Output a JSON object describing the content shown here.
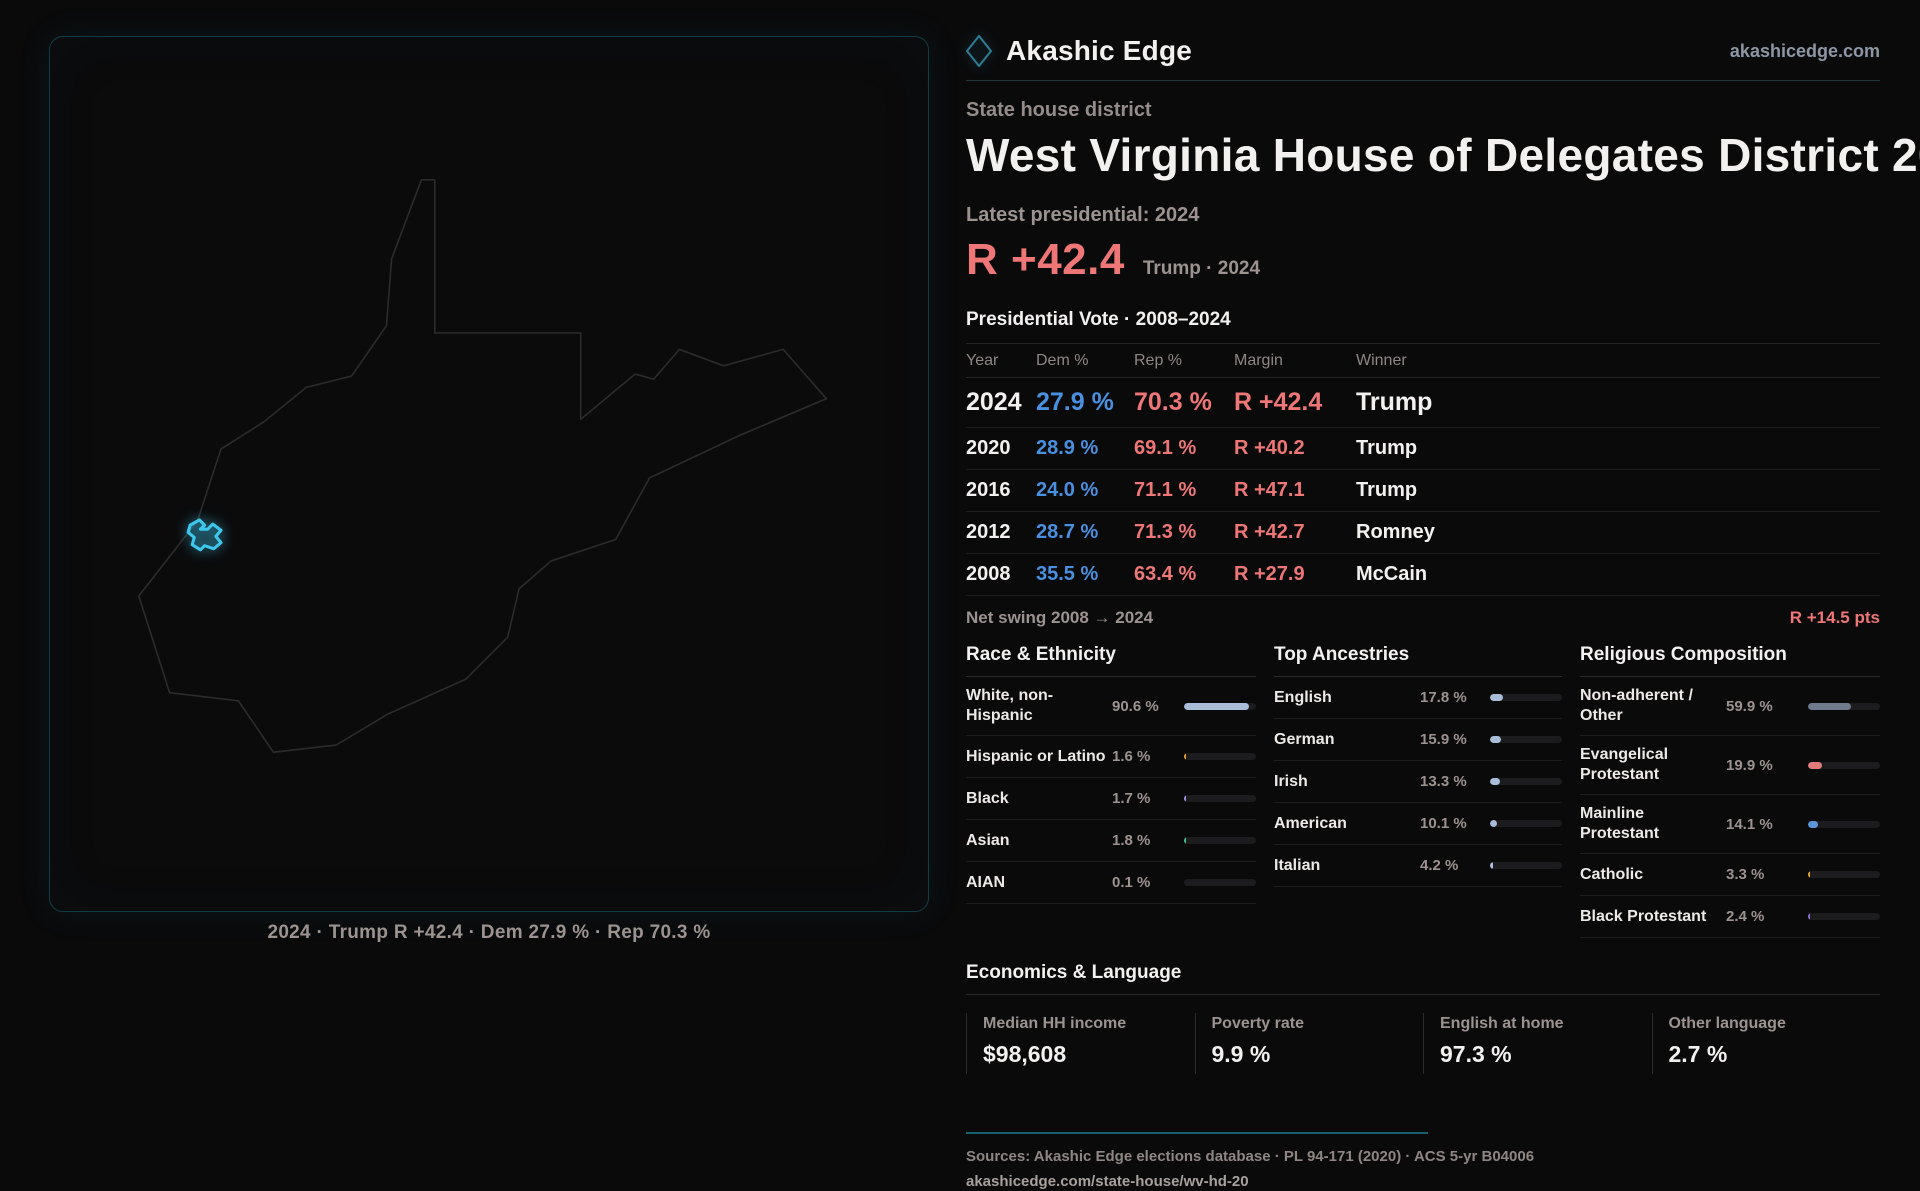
{
  "brand": {
    "name": "Akashic Edge",
    "domain": "akashicedge.com"
  },
  "page": {
    "kicker": "State house district",
    "title": "West Virginia House of Delegates District 20",
    "latest_label": "Latest presidential: 2024",
    "headline_margin": "R +42.4",
    "headline_detail": "Trump · 2024"
  },
  "colors": {
    "accent_red": "#ee7676",
    "accent_blue": "#4a90e0",
    "district_cyan": "#3dc7ed",
    "teal_rule": "#17606e"
  },
  "map": {
    "caption": "2024 · Trump R +42.4 · Dem 27.9 % · Rep 70.3 %"
  },
  "vote_table": {
    "title": "Presidential Vote · 2008–2024",
    "columns": [
      "Year",
      "Dem %",
      "Rep %",
      "Margin",
      "Winner"
    ],
    "rows": [
      {
        "year": "2024",
        "dem": "27.9 %",
        "rep": "70.3 %",
        "margin": "R +42.4",
        "winner": "Trump"
      },
      {
        "year": "2020",
        "dem": "28.9 %",
        "rep": "69.1 %",
        "margin": "R +40.2",
        "winner": "Trump"
      },
      {
        "year": "2016",
        "dem": "24.0 %",
        "rep": "71.1 %",
        "margin": "R +47.1",
        "winner": "Trump"
      },
      {
        "year": "2012",
        "dem": "28.7 %",
        "rep": "71.3 %",
        "margin": "R +42.7",
        "winner": "Romney"
      },
      {
        "year": "2008",
        "dem": "35.5 %",
        "rep": "63.4 %",
        "margin": "R +27.9",
        "winner": "McCain"
      }
    ]
  },
  "net_swing": {
    "label": "Net swing 2008 → 2024",
    "value": "R +14.5 pts"
  },
  "demographics": {
    "race": {
      "title": "Race & Ethnicity",
      "rows": [
        {
          "label": "White, non-Hispanic",
          "value": "90.6 %",
          "pct": 90.6,
          "color": "#a9bdd8"
        },
        {
          "label": "Hispanic or Latino",
          "value": "1.6 %",
          "pct": 1.6,
          "color": "#df9f3a"
        },
        {
          "label": "Black",
          "value": "1.7 %",
          "pct": 1.7,
          "color": "#a393e0"
        },
        {
          "label": "Asian",
          "value": "1.8 %",
          "pct": 1.8,
          "color": "#3fc08d"
        },
        {
          "label": "AIAN",
          "value": "0.1 %",
          "pct": 0.1,
          "color": "#a9bdd8"
        }
      ]
    },
    "ancestries": {
      "title": "Top Ancestries",
      "rows": [
        {
          "label": "English",
          "value": "17.8 %",
          "pct": 17.8,
          "color": "#a9bdd8"
        },
        {
          "label": "German",
          "value": "15.9 %",
          "pct": 15.9,
          "color": "#a9bdd8"
        },
        {
          "label": "Irish",
          "value": "13.3 %",
          "pct": 13.3,
          "color": "#a9bdd8"
        },
        {
          "label": "American",
          "value": "10.1 %",
          "pct": 10.1,
          "color": "#a9bdd8"
        },
        {
          "label": "Italian",
          "value": "4.2 %",
          "pct": 4.2,
          "color": "#a9bdd8"
        }
      ]
    },
    "religion": {
      "title": "Religious Composition",
      "rows": [
        {
          "label": "Non-adherent / Other",
          "value": "59.9 %",
          "pct": 59.9,
          "color": "#6f7b8c"
        },
        {
          "label": "Evangelical Protestant",
          "value": "19.9 %",
          "pct": 19.9,
          "color": "#e27c7c"
        },
        {
          "label": "Mainline Protestant",
          "value": "14.1 %",
          "pct": 14.1,
          "color": "#5e95da"
        },
        {
          "label": "Catholic",
          "value": "3.3 %",
          "pct": 3.3,
          "color": "#dfaa1e"
        },
        {
          "label": "Black Protestant",
          "value": "2.4 %",
          "pct": 2.4,
          "color": "#8f6fd8"
        }
      ]
    }
  },
  "economics": {
    "title": "Economics & Language",
    "stats": [
      {
        "label": "Median HH income",
        "value": "$98,608"
      },
      {
        "label": "Poverty rate",
        "value": "9.9 %"
      },
      {
        "label": "English at home",
        "value": "97.3 %"
      },
      {
        "label": "Other language",
        "value": "2.7 %"
      }
    ]
  },
  "footer": {
    "sources": "Sources: Akashic Edge elections database · PL 94-171 (2020) · ACS 5-yr B04006",
    "permalink": "akashicedge.com/state-house/wv-hd-20"
  }
}
